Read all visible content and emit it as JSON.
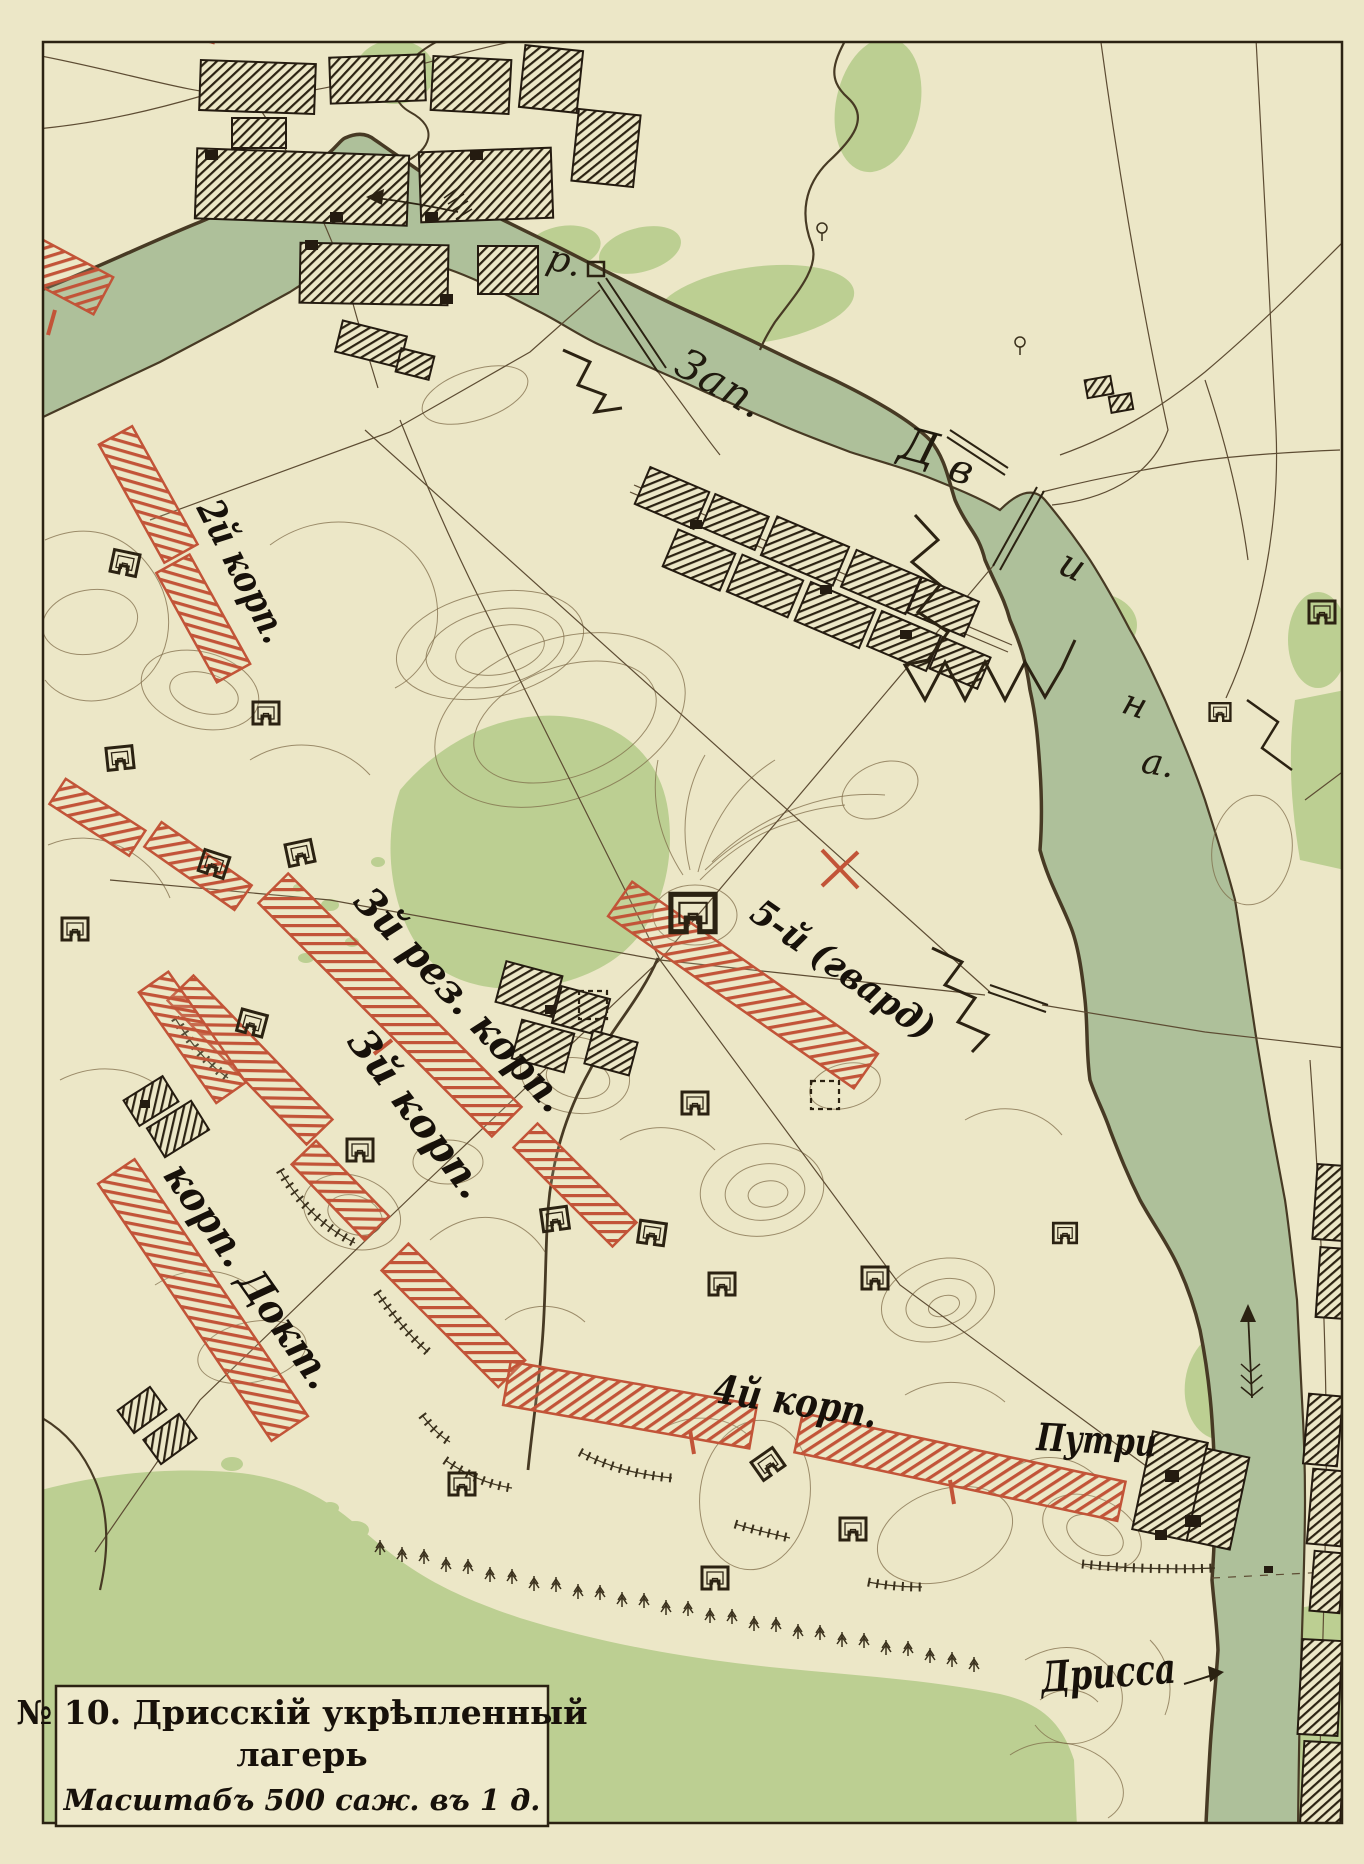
{
  "map_title_number": "№ 10",
  "title_box": {
    "line1": "№ 10. Дрисскій укрѣпленный",
    "line2": "лагерь",
    "scale_line": "Масштабъ 500 саж. въ 1 д."
  },
  "river_label": {
    "abbrev": "р.",
    "word1": "Зап.",
    "letters": [
      "Д",
      "в",
      "и",
      "н",
      "а."
    ]
  },
  "unit_labels": {
    "corps2": "2й корп.",
    "corps3res": "3й рез. корп.",
    "corps3": "3й корп.",
    "corps5": "5-й (гвард)",
    "corpsDoct": "корп. Докт.",
    "corps4": "4й корп."
  },
  "place_labels": {
    "putri": "Путри",
    "drissa": "Дрисса"
  },
  "colors": {
    "paper": "#ece7c7",
    "river_green": "#aec09a",
    "forest_green": "#bccf92",
    "ink": "#2b2212",
    "contour_brown": "#7b6845",
    "troop_red": "#c25438"
  },
  "legend": {
    "red_strips_meaning": "troop-positions",
    "hatched_blocks_meaning": "villages",
    "square_symbols_meaning": "redoubts"
  }
}
